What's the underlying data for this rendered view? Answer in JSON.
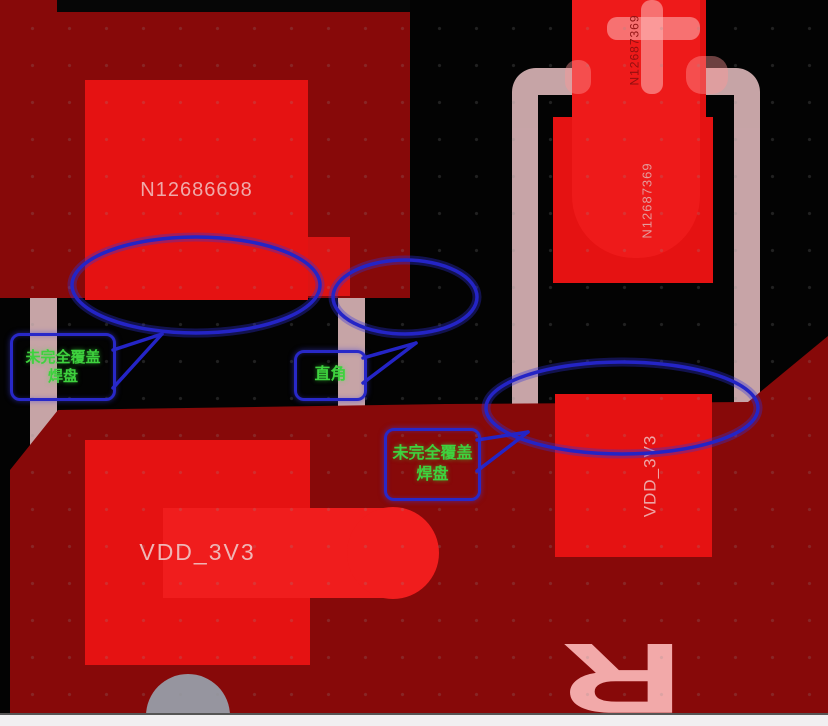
{
  "scene": {
    "type": "pcb-layout-editor-screenshot",
    "description": "PCB copper layer view with design-review annotations"
  },
  "nets": {
    "top_left_pad": "N12686698",
    "right_pad": "N12687369",
    "power": "VDD_3V3"
  },
  "pads": [
    {
      "id": "pad-top-left",
      "net": "N12686698",
      "orientation": "horizontal"
    },
    {
      "id": "pad-top-right",
      "net": "N12687369",
      "orientation": "vertical"
    },
    {
      "id": "pad-bottom-left",
      "net": "VDD_3V3",
      "orientation": "horizontal"
    },
    {
      "id": "pad-bottom-right",
      "net": "VDD_3V3",
      "orientation": "vertical"
    }
  ],
  "annotations": {
    "callouts": [
      {
        "id": "callout-left",
        "line1": "未完全覆盖",
        "line2": "焊盘"
      },
      {
        "id": "callout-middle",
        "line1": "直角",
        "line2": ""
      },
      {
        "id": "callout-right",
        "line1": "未完全覆盖",
        "line2": "焊盘"
      }
    ],
    "highlight_ellipse_count": 3,
    "outline_color": "#2828c8",
    "text_color": "#3ed23e"
  },
  "silkscreen": {
    "refdes": "R",
    "polarity_mark": "+",
    "color": "#f8cdd0"
  },
  "colors": {
    "background": "#030303",
    "copper_pour": "#870909",
    "copper_bright": "#e51212",
    "pad_label_pink": "#efa9a9",
    "annotation_blue": "#2828c8",
    "annotation_green": "#3ed23e",
    "bottom_strip": "#f1eff1"
  }
}
